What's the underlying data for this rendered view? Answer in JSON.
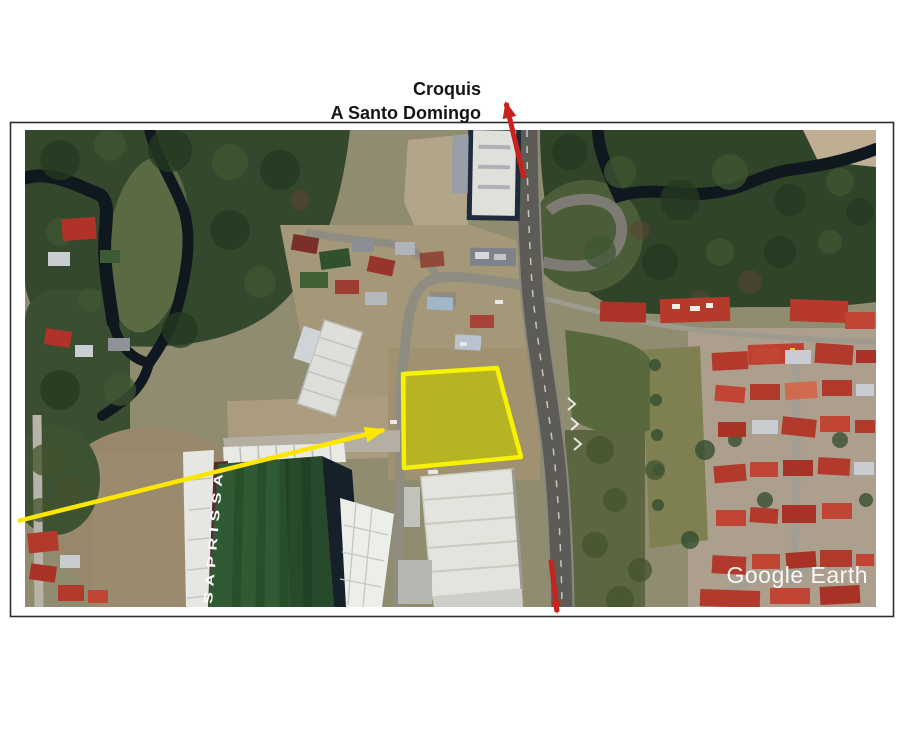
{
  "title": {
    "line1": "Croquis",
    "line2": "A Santo Domingo"
  },
  "map": {
    "watermark": "Google Earth",
    "stadium_label": "SAPRISSA"
  },
  "annotations": {
    "plot_stroke": "#f7f200",
    "plot_fill": "rgba(255,242,0,0.5)",
    "arrow_red": "#c8221f",
    "arrow_yellow": "#ffe600"
  },
  "frame_color": "#2e2e2e"
}
